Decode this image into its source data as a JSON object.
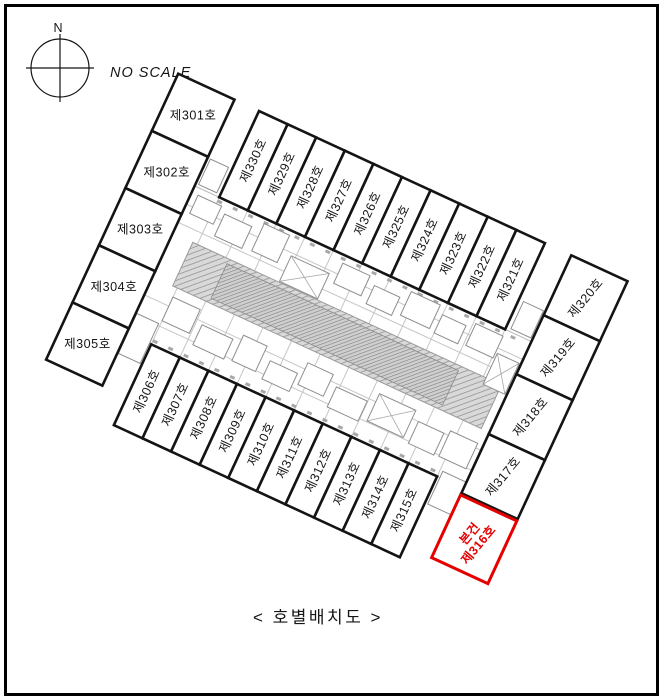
{
  "compass": {
    "north_label": "N"
  },
  "scale_note": "NO SCALE",
  "caption": "< 호별배치도 >",
  "top_row": {
    "labels": [
      "제330호",
      "제329호",
      "제328호",
      "제327호",
      "제326호",
      "제325호",
      "제324호",
      "제323호",
      "제322호",
      "제321호"
    ]
  },
  "bottom_row": {
    "labels": [
      "제306호",
      "제307호",
      "제308호",
      "제309호",
      "제310호",
      "제311호",
      "제312호",
      "제313호",
      "제314호",
      "제315호"
    ]
  },
  "left_column": {
    "labels": [
      "제301호",
      "제302호",
      "제303호",
      "제304호",
      "제305호"
    ]
  },
  "right_column": {
    "labels": [
      "제320호",
      "제319호",
      "제318호",
      "제317호"
    ]
  },
  "subject_unit": {
    "tag": "본건",
    "label": "제316호",
    "color": "#e60000"
  },
  "colors": {
    "line": "#141414",
    "subject": "#e60000",
    "plan_gray": "#8e8e8e"
  }
}
